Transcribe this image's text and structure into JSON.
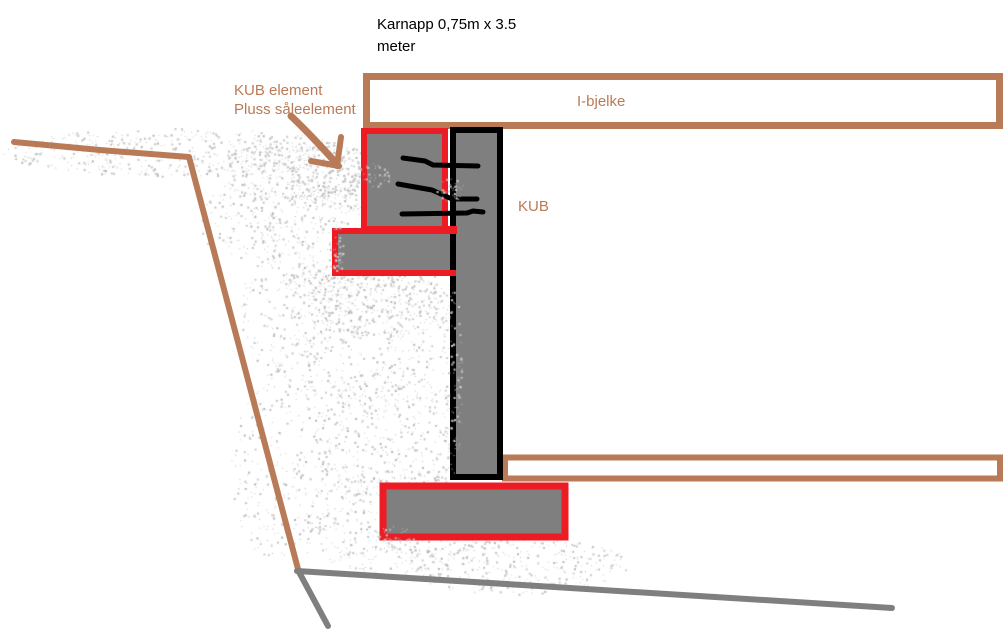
{
  "labels": {
    "karnapp_line1": "Karnapp 0,75m x 3.5",
    "karnapp_line2": "meter",
    "kub_element_line1": "KUB element",
    "kub_element_line2": "Pluss såleelement",
    "i_bjelke": "I-bjelke",
    "kub": "KUB"
  },
  "icons": {
    "annotation_arrow": "hand-drawn-arrow-down-right"
  },
  "colors": {
    "brown": "#B97A57",
    "red": "#ED1C24",
    "gray_fill": "#7F7F7F",
    "gray_line": "#7F7F7F",
    "speckle": "#C3C3C3",
    "black": "#000000",
    "background": "#FFFFFF"
  }
}
